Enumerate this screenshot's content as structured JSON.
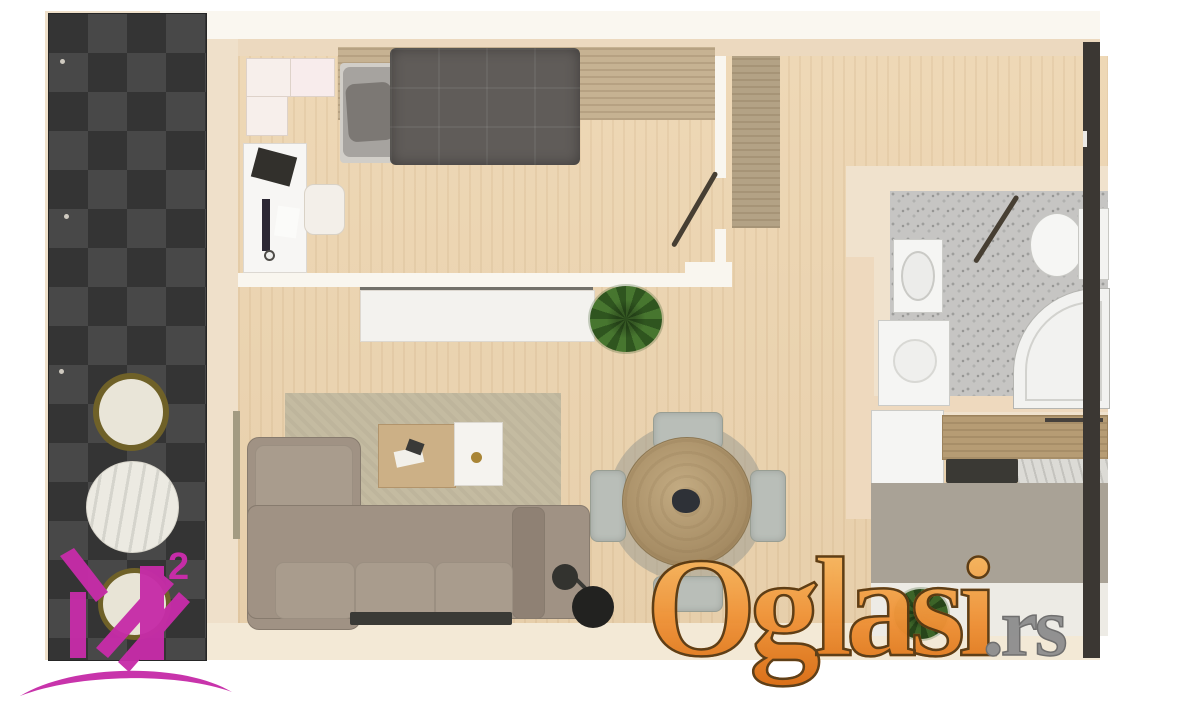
{
  "watermark": {
    "text": "Oglasi",
    "tld": ".rs",
    "orange_top": "#fac570",
    "orange_bottom": "#d96c12",
    "outline_color": "#5a3a12",
    "tld_color": "#8f8f8f"
  },
  "logo": {
    "superscript": "2",
    "color": "#c62ca8"
  },
  "palette": {
    "page_background": "#ffffff",
    "wall_beige": "#efe0ca",
    "wood_floor": "#ecd5b2",
    "balcony_tile_dark": "#3a3a3a",
    "sofa_taupe": "#a09284",
    "rug_olive": "#c4bba1",
    "bed_duvet_gray": "#605c59",
    "bathroom_terrazzo": "#c6c5c3",
    "kitchen_floor_gray": "#a9a296",
    "counter_wood": "#b69c74",
    "dining_table_wood": "#b29a73",
    "entry_strip_dark": "#3b3733"
  }
}
